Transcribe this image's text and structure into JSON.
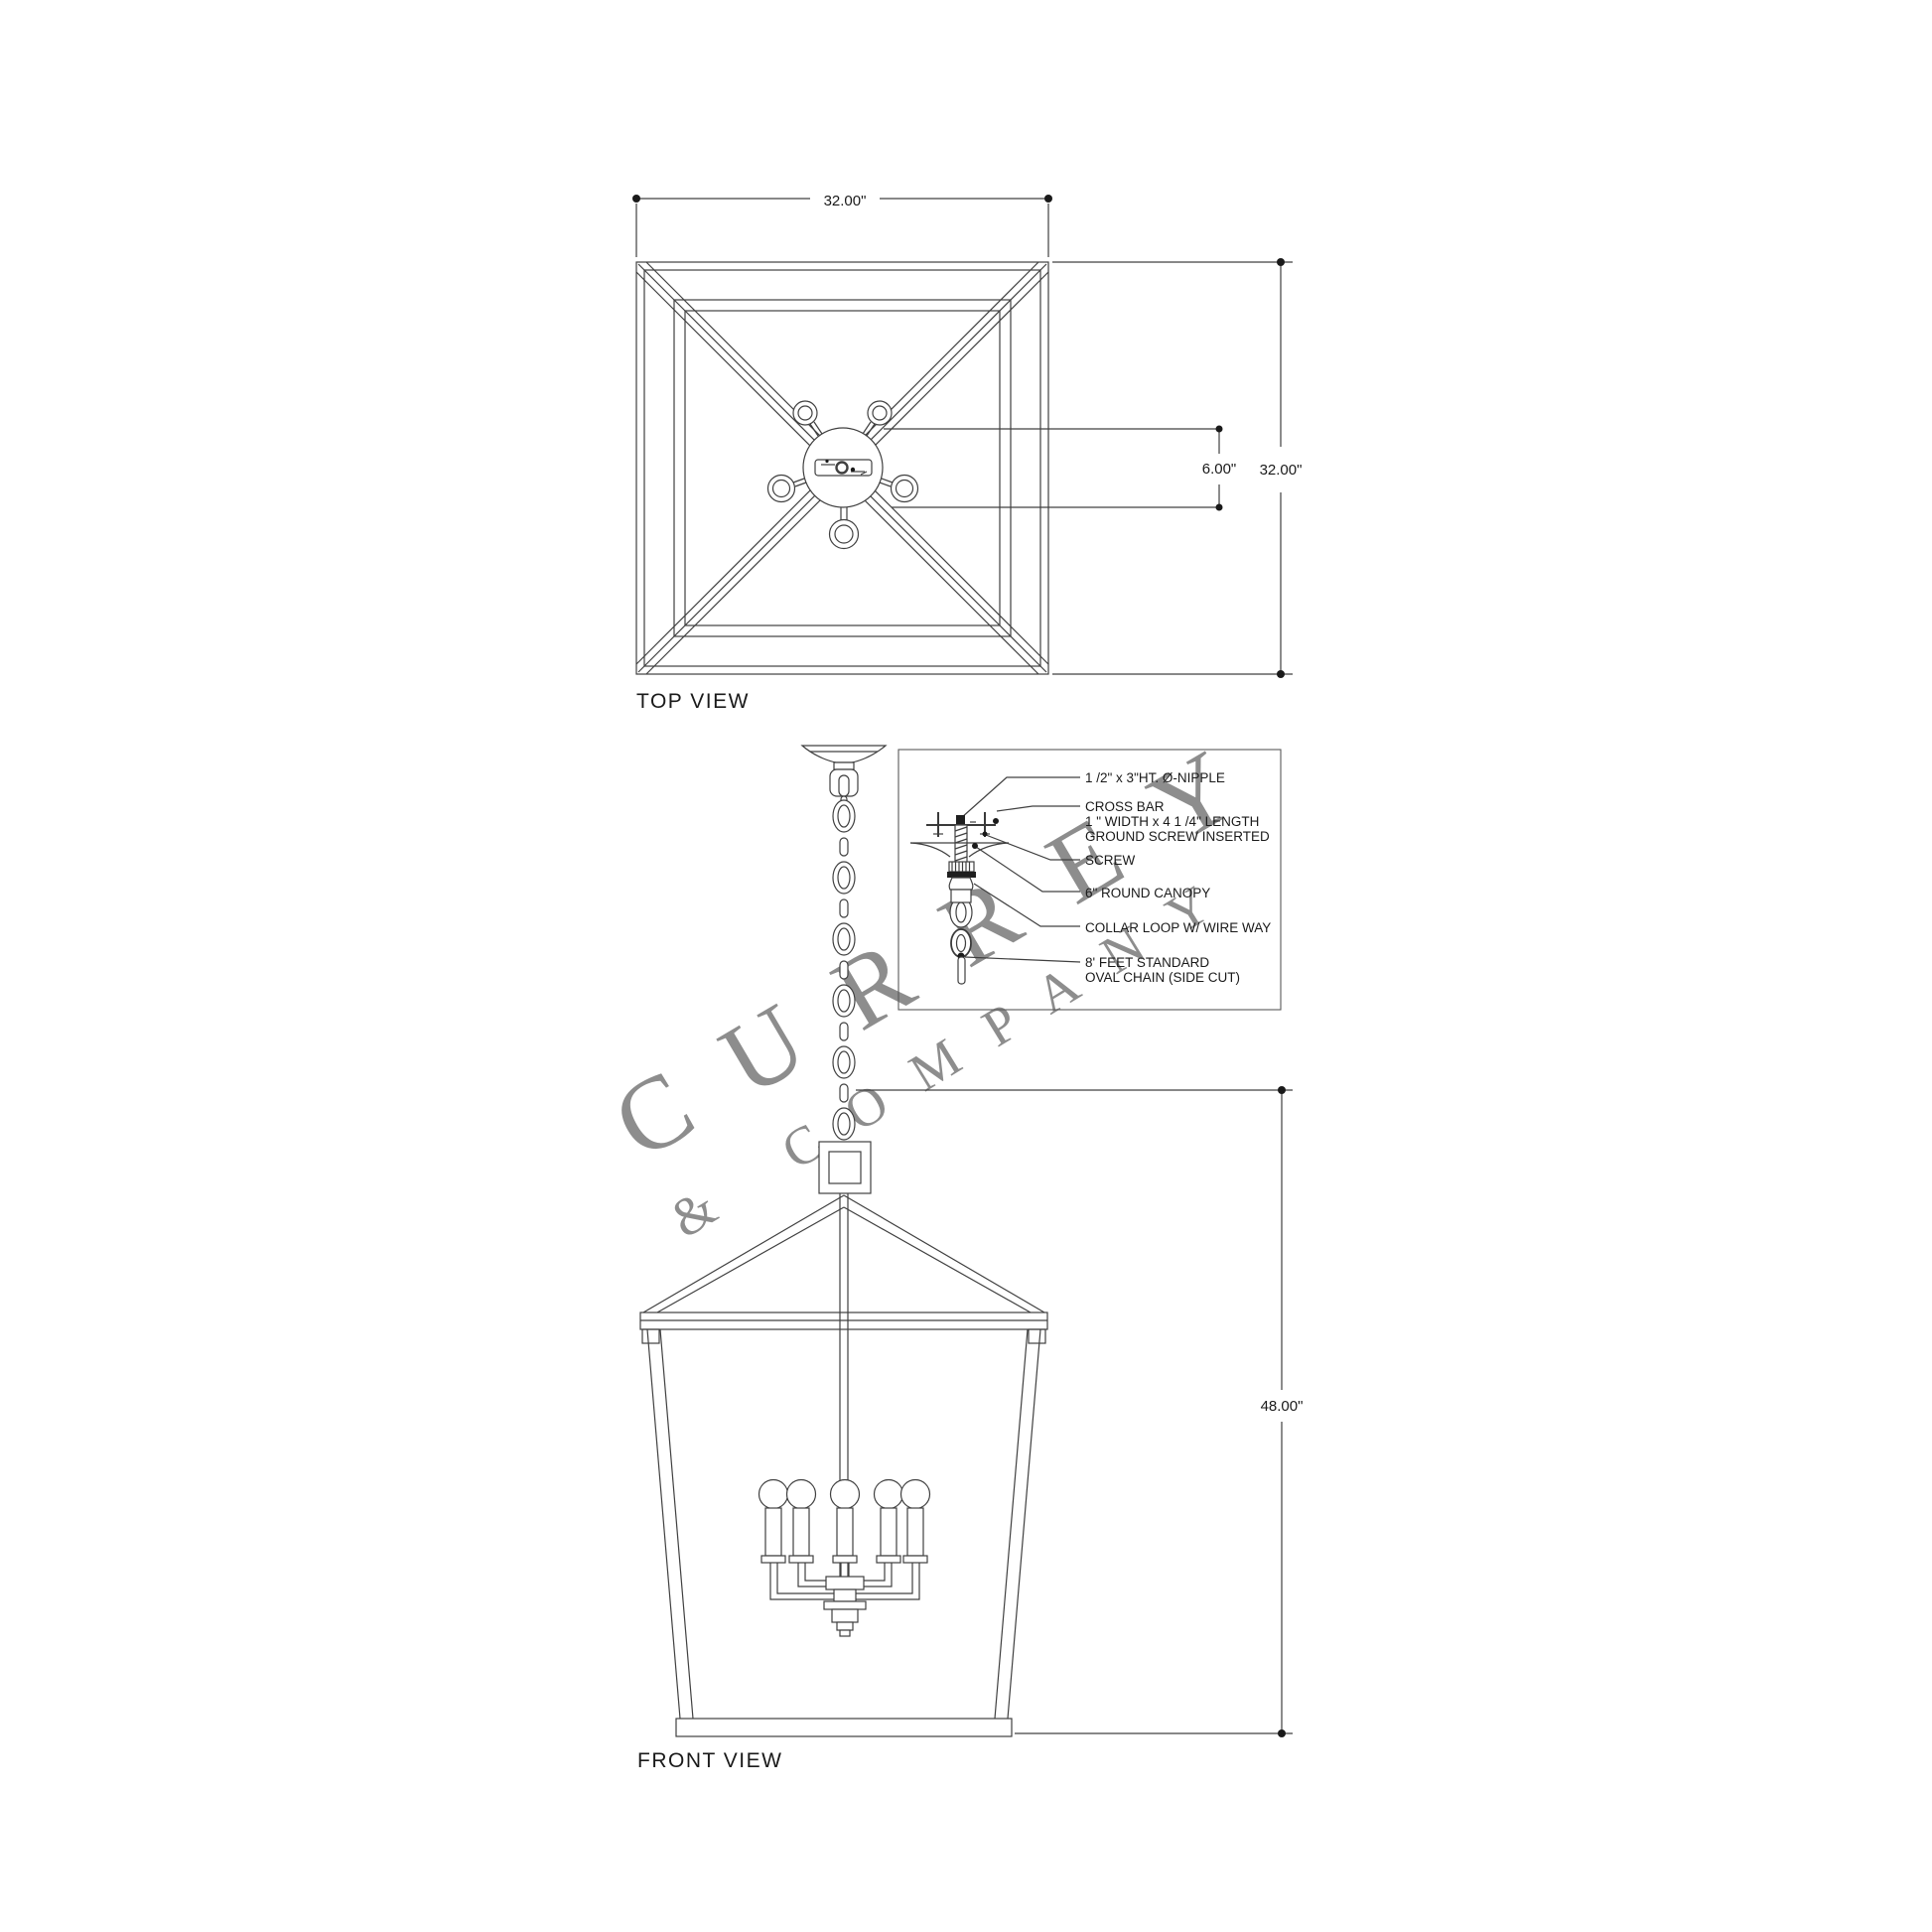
{
  "page": {
    "background": "#ffffff",
    "line_color": "#404040",
    "text_color": "#1a1a1a",
    "watermark_color": "#8d8d8d"
  },
  "watermark": {
    "line1": "CURREY",
    "line2": "& COMPANY"
  },
  "top_view": {
    "label": "TOP VIEW",
    "dim_width": "32.00\"",
    "dim_height": "32.00\"",
    "dim_canopy": "6.00\""
  },
  "front_view": {
    "label": "FRONT VIEW",
    "dim_height": "48.00\""
  },
  "detail": {
    "labels": [
      "1 /2\" x 3\"HT. Ø-NIPPLE",
      "CROSS BAR",
      "1 \" WIDTH x 4 1 /4\" LENGTH",
      "GROUND SCREW INSERTED",
      "SCREW",
      "6\" ROUND CANOPY",
      "COLLAR LOOP W/ WIRE WAY",
      "8' FEET STANDARD",
      "OVAL CHAIN (SIDE CUT)"
    ]
  }
}
